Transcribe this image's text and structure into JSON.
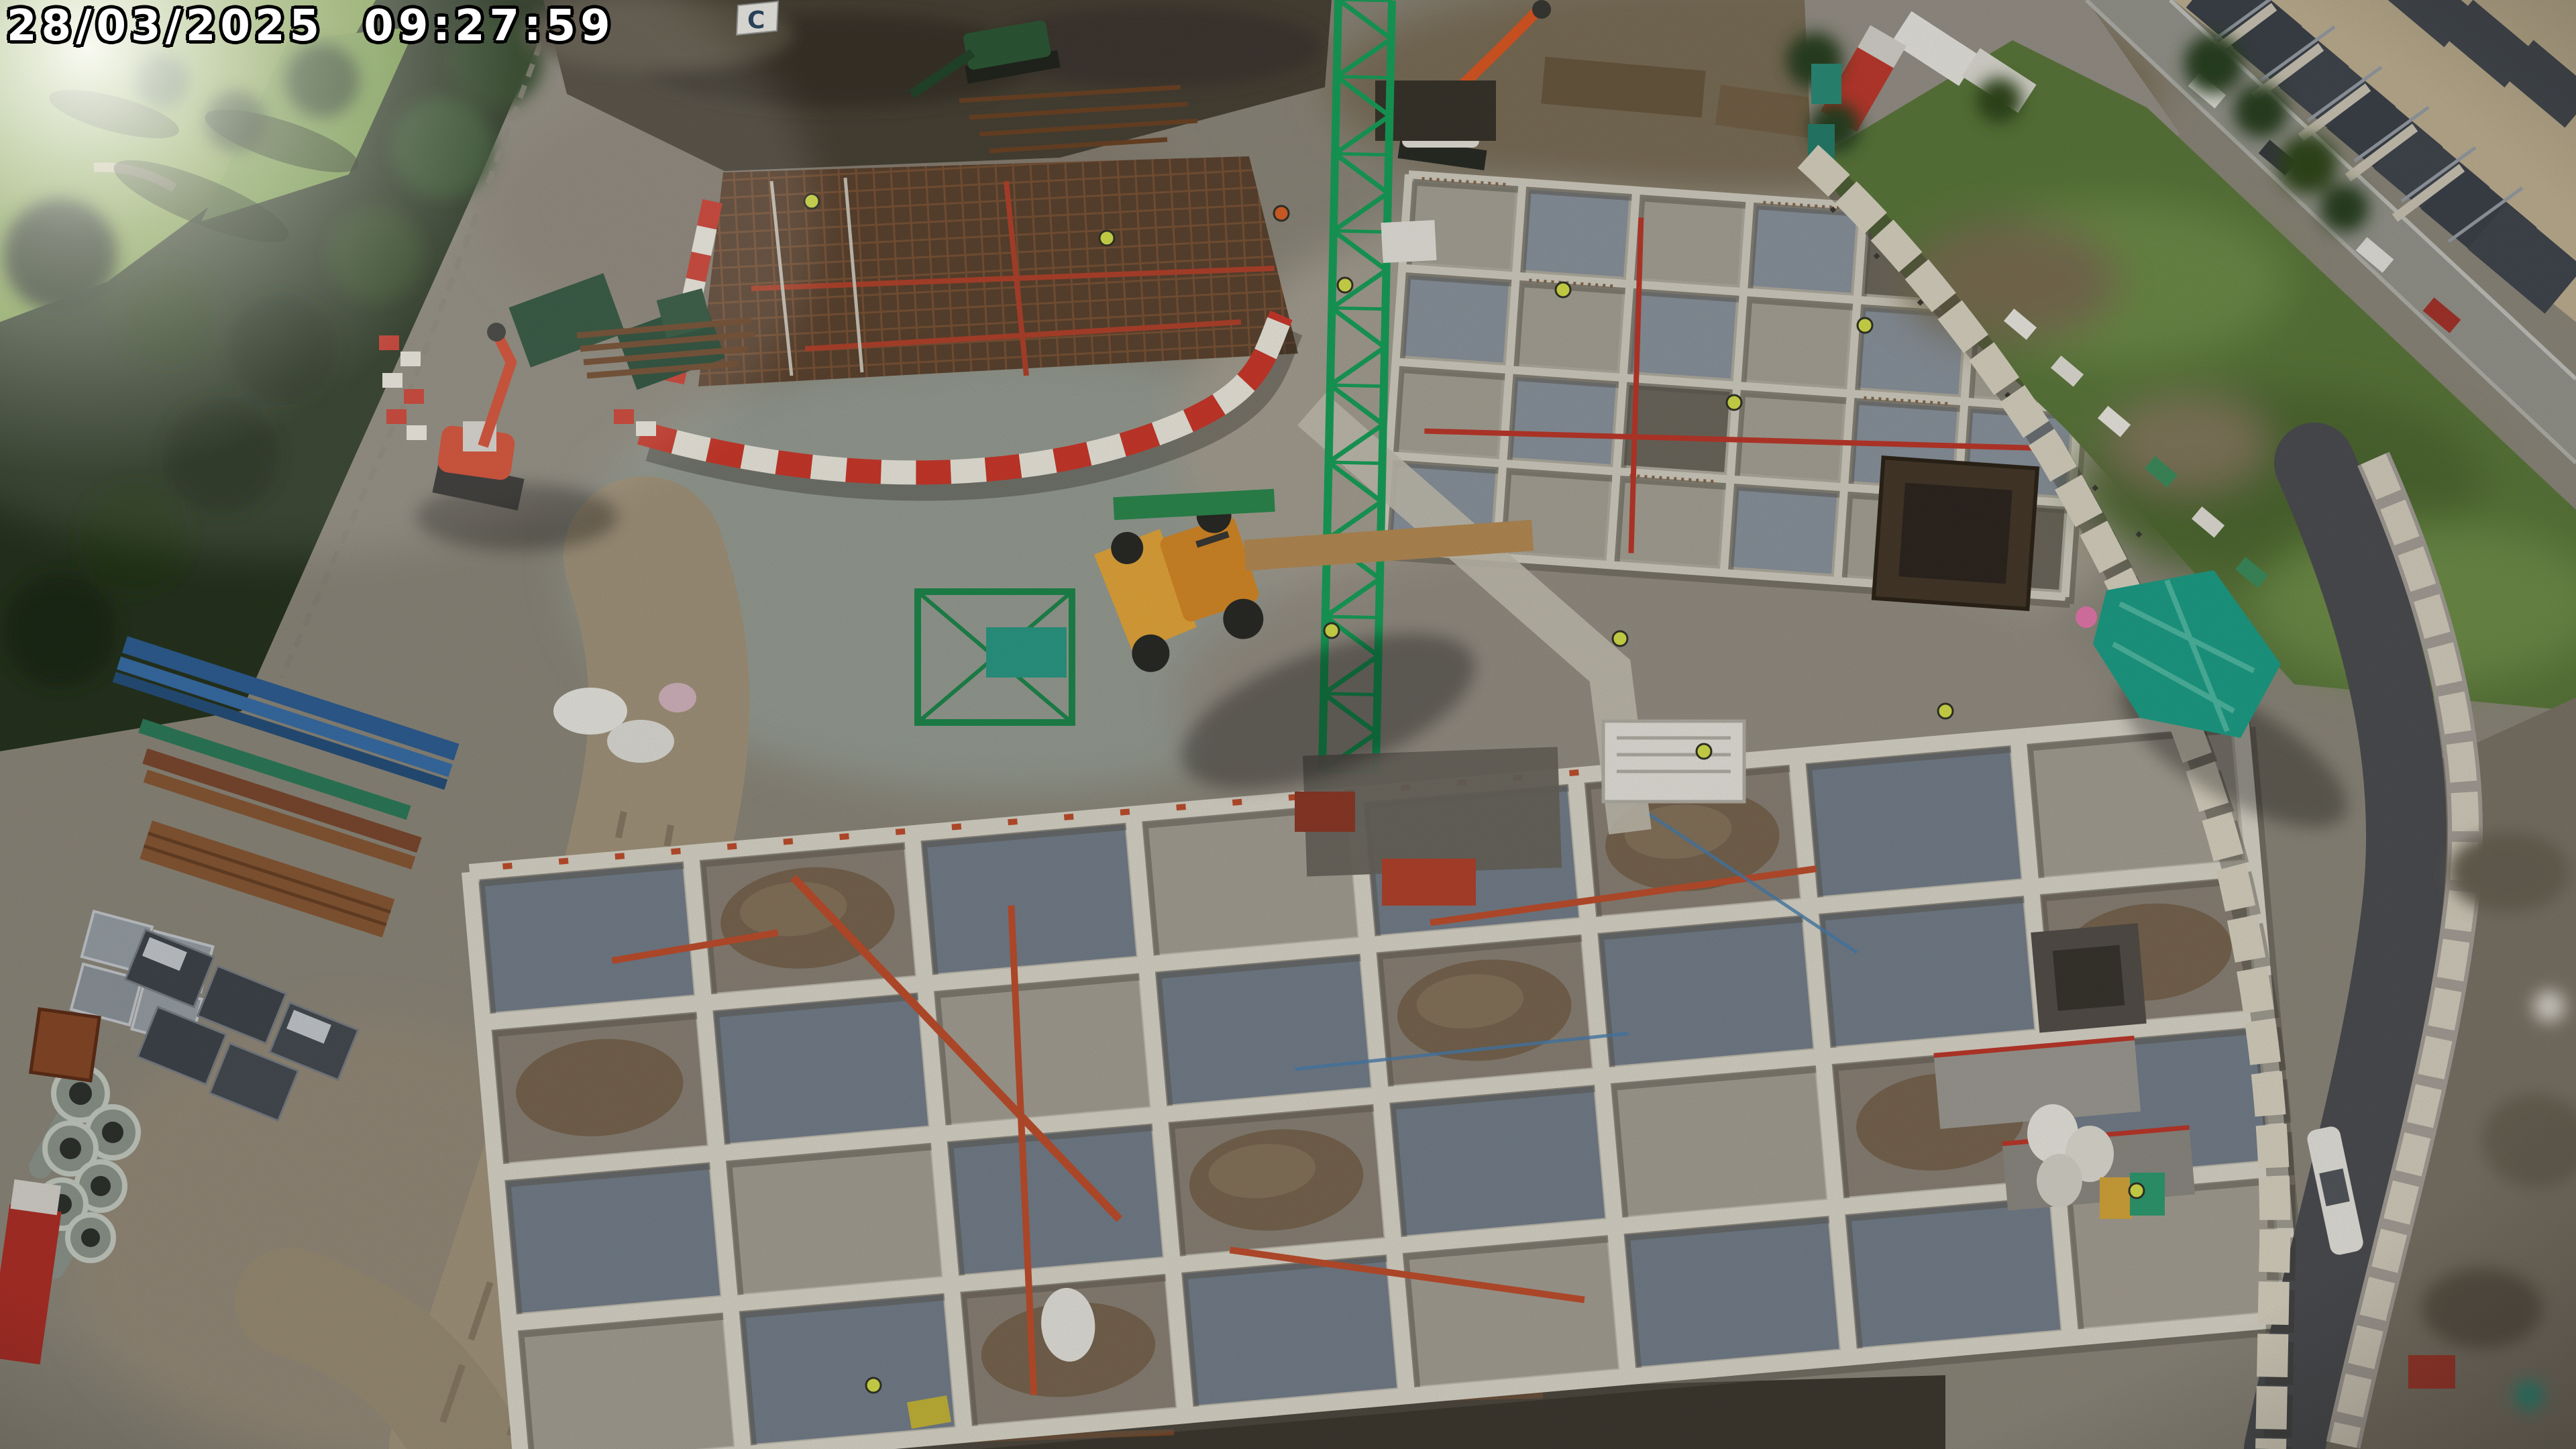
{
  "overlay": {
    "timestamp": "28/03/2025 09:27:59"
  },
  "scene": {
    "flag_label": "C",
    "elements": [
      "golf-course-woodland",
      "tower-crane",
      "rebar-slab-deck",
      "foundation-grid-north",
      "foundation-maze-south",
      "red-white-water-barriers",
      "concrete-block-barrier-line",
      "haul-road",
      "public-road",
      "terraced-houses",
      "grass-verge",
      "green-tarpaulin-stack",
      "material-laydown",
      "concrete-pipes",
      "site-dumper",
      "mini-excavator",
      "green-excavator",
      "scaffold-tower",
      "workers-hi-vis",
      "dirt-track",
      "white-bulk-bags",
      "soil-heap"
    ]
  },
  "colors": {
    "timestamp_text": "#ffffff",
    "timestamp_outline": "#000000",
    "crane_green": "#18a35b",
    "barrier_red": "#d03a2c",
    "barrier_white": "#f1ede2",
    "block_barrier_cream": "#dcd6c4",
    "tarp_teal": "#1ea189",
    "hivis_yellow": "#d9e34c",
    "deck_rust": "#5e4531",
    "rebar_line": "#7c5538",
    "wall_white": "#ddd9cc",
    "cell_gravel_blue": "#76818d",
    "cell_gravel_light": "#a7a296",
    "soil_mound_brown": "#7a6751",
    "ground_gravel": "#8f8a7d",
    "ground_light": "#a29c8e",
    "soil_dark": "#4a4437",
    "dirt_track": "#a5977e",
    "woodland_green": "#27351f",
    "fairway_green": "#86a84f",
    "verge_green": "#5d7a3d",
    "asphalt_dark": "#4e4f53",
    "road_grey": "#98988f",
    "roof_dark": "#3e434b",
    "house_wall": "#c2b394",
    "dumper_orange": "#d98c28",
    "excavator_red": "#d8472b",
    "excavator_green": "#2e5b38",
    "pipe_red": "#c2502e",
    "pipes_blue": "#2f6096",
    "timber_brown": "#8a5a36",
    "blocks_grey": "#9aa2a8"
  }
}
